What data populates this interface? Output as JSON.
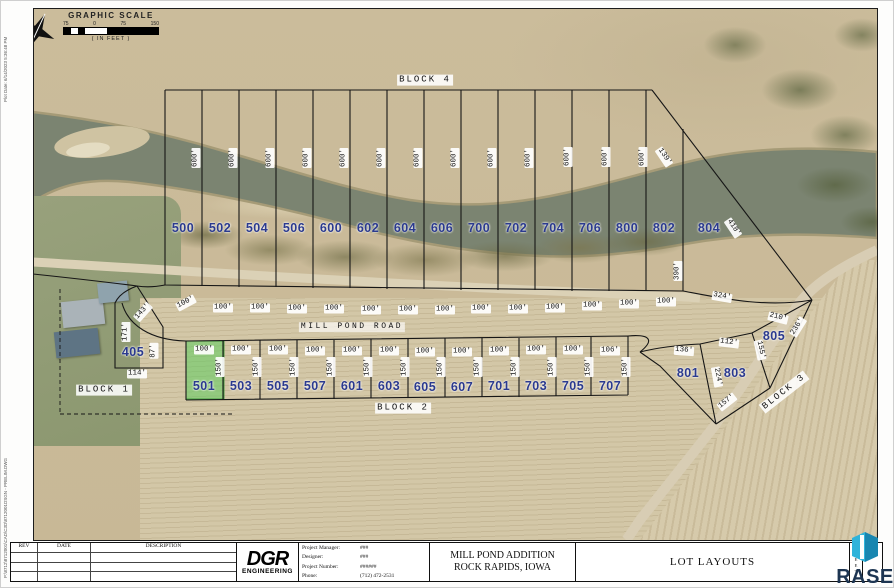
{
  "margins": {
    "plot_date": "Plot Date: 6/14/2023 5:36:48 PM",
    "file_path": "P:\\8712\\8712001\\CAD\\C3D\\8712001DSGN - PRELIM.DWG"
  },
  "scale": {
    "title": "GRAPHIC SCALE",
    "ticks": [
      "75",
      "0",
      "75",
      "150"
    ],
    "units_note": "( IN FEET )"
  },
  "map": {
    "road_label": {
      "text": "MILL POND ROAD"
    },
    "highlighted_lot": "501",
    "colors": {
      "lot_number_text": "#2b3a8f",
      "highlight_green": "#5ecc5e",
      "river": "#7b8471",
      "field": "#d3c7a7"
    },
    "block_labels": [
      {
        "text": "BLOCK 4",
        "x": 425,
        "y": 80,
        "r": 0
      },
      {
        "text": "BLOCK 1",
        "x": 104,
        "y": 390,
        "r": 0
      },
      {
        "text": "BLOCK 2",
        "x": 403,
        "y": 408,
        "r": 0
      },
      {
        "text": "BLOCK 3",
        "x": 784,
        "y": 392,
        "r": -38
      }
    ],
    "lot_numbers": [
      {
        "n": "500",
        "x": 183,
        "y": 228
      },
      {
        "n": "502",
        "x": 220,
        "y": 228
      },
      {
        "n": "504",
        "x": 257,
        "y": 228
      },
      {
        "n": "506",
        "x": 294,
        "y": 228
      },
      {
        "n": "600",
        "x": 331,
        "y": 228
      },
      {
        "n": "602",
        "x": 368,
        "y": 228
      },
      {
        "n": "604",
        "x": 405,
        "y": 228
      },
      {
        "n": "606",
        "x": 442,
        "y": 228
      },
      {
        "n": "700",
        "x": 479,
        "y": 228
      },
      {
        "n": "702",
        "x": 516,
        "y": 228
      },
      {
        "n": "704",
        "x": 553,
        "y": 228
      },
      {
        "n": "706",
        "x": 590,
        "y": 228
      },
      {
        "n": "800",
        "x": 627,
        "y": 228
      },
      {
        "n": "802",
        "x": 664,
        "y": 228
      },
      {
        "n": "804",
        "x": 709,
        "y": 228
      },
      {
        "n": "405",
        "x": 133,
        "y": 352
      },
      {
        "n": "501",
        "x": 204,
        "y": 386,
        "hl": true
      },
      {
        "n": "503",
        "x": 241,
        "y": 386
      },
      {
        "n": "505",
        "x": 278,
        "y": 386
      },
      {
        "n": "507",
        "x": 315,
        "y": 386
      },
      {
        "n": "601",
        "x": 352,
        "y": 386
      },
      {
        "n": "603",
        "x": 389,
        "y": 386
      },
      {
        "n": "605",
        "x": 425,
        "y": 387
      },
      {
        "n": "607",
        "x": 462,
        "y": 387
      },
      {
        "n": "701",
        "x": 499,
        "y": 386
      },
      {
        "n": "703",
        "x": 536,
        "y": 386
      },
      {
        "n": "705",
        "x": 573,
        "y": 386
      },
      {
        "n": "707",
        "x": 610,
        "y": 386
      },
      {
        "n": "801",
        "x": 688,
        "y": 373
      },
      {
        "n": "803",
        "x": 735,
        "y": 373
      },
      {
        "n": "805",
        "x": 774,
        "y": 336
      }
    ],
    "dimensions": [
      {
        "text": "600'",
        "x": 196,
        "y": 158,
        "r": -90
      },
      {
        "text": "600'",
        "x": 233,
        "y": 158,
        "r": -90
      },
      {
        "text": "600'",
        "x": 270,
        "y": 158,
        "r": -90
      },
      {
        "text": "600'",
        "x": 307,
        "y": 158,
        "r": -90
      },
      {
        "text": "600'",
        "x": 344,
        "y": 158,
        "r": -90
      },
      {
        "text": "600'",
        "x": 381,
        "y": 158,
        "r": -90
      },
      {
        "text": "600'",
        "x": 418,
        "y": 158,
        "r": -90
      },
      {
        "text": "600'",
        "x": 455,
        "y": 158,
        "r": -90
      },
      {
        "text": "600'",
        "x": 492,
        "y": 158,
        "r": -90
      },
      {
        "text": "600'",
        "x": 529,
        "y": 158,
        "r": -90
      },
      {
        "text": "600'",
        "x": 568,
        "y": 157,
        "r": -90
      },
      {
        "text": "600'",
        "x": 606,
        "y": 157,
        "r": -90
      },
      {
        "text": "600'",
        "x": 643,
        "y": 157,
        "r": -90
      },
      {
        "text": "139'",
        "x": 664,
        "y": 157,
        "r": 56
      },
      {
        "text": "418'",
        "x": 733,
        "y": 228,
        "r": 56
      },
      {
        "text": "390'",
        "x": 678,
        "y": 271,
        "r": -90
      },
      {
        "text": "324'",
        "x": 722,
        "y": 297,
        "r": 10
      },
      {
        "text": "100'",
        "x": 186,
        "y": 303,
        "r": -28
      },
      {
        "text": "100'",
        "x": 223,
        "y": 308,
        "r": 0
      },
      {
        "text": "100'",
        "x": 260,
        "y": 308,
        "r": 0
      },
      {
        "text": "100'",
        "x": 297,
        "y": 309,
        "r": 0
      },
      {
        "text": "100'",
        "x": 334,
        "y": 309,
        "r": 0
      },
      {
        "text": "100'",
        "x": 371,
        "y": 310,
        "r": 0
      },
      {
        "text": "100'",
        "x": 408,
        "y": 310,
        "r": 0
      },
      {
        "text": "100'",
        "x": 445,
        "y": 310,
        "r": 0
      },
      {
        "text": "100'",
        "x": 481,
        "y": 309,
        "r": 0
      },
      {
        "text": "100'",
        "x": 518,
        "y": 309,
        "r": 0
      },
      {
        "text": "100'",
        "x": 555,
        "y": 308,
        "r": 0
      },
      {
        "text": "100'",
        "x": 592,
        "y": 306,
        "r": 0
      },
      {
        "text": "100'",
        "x": 629,
        "y": 304,
        "r": 0
      },
      {
        "text": "100'",
        "x": 666,
        "y": 302,
        "r": 0
      },
      {
        "text": "100'",
        "x": 204,
        "y": 350,
        "r": 0
      },
      {
        "text": "100'",
        "x": 241,
        "y": 350,
        "r": 0
      },
      {
        "text": "100'",
        "x": 278,
        "y": 350,
        "r": 0
      },
      {
        "text": "100'",
        "x": 315,
        "y": 351,
        "r": 0
      },
      {
        "text": "100'",
        "x": 352,
        "y": 351,
        "r": 0
      },
      {
        "text": "100'",
        "x": 389,
        "y": 351,
        "r": 0
      },
      {
        "text": "100'",
        "x": 425,
        "y": 352,
        "r": 0
      },
      {
        "text": "100'",
        "x": 462,
        "y": 352,
        "r": 0
      },
      {
        "text": "100'",
        "x": 499,
        "y": 351,
        "r": 0
      },
      {
        "text": "100'",
        "x": 536,
        "y": 350,
        "r": 0
      },
      {
        "text": "100'",
        "x": 573,
        "y": 350,
        "r": 0
      },
      {
        "text": "106'",
        "x": 610,
        "y": 351,
        "r": 0
      },
      {
        "text": "150'",
        "x": 220,
        "y": 367,
        "r": -90
      },
      {
        "text": "150'",
        "x": 257,
        "y": 367,
        "r": -90
      },
      {
        "text": "150'",
        "x": 294,
        "y": 367,
        "r": -90
      },
      {
        "text": "150'",
        "x": 331,
        "y": 367,
        "r": -90
      },
      {
        "text": "150'",
        "x": 368,
        "y": 367,
        "r": -90
      },
      {
        "text": "150'",
        "x": 405,
        "y": 367,
        "r": -90
      },
      {
        "text": "150'",
        "x": 441,
        "y": 367,
        "r": -90
      },
      {
        "text": "150'",
        "x": 478,
        "y": 367,
        "r": -90
      },
      {
        "text": "150'",
        "x": 515,
        "y": 367,
        "r": -90
      },
      {
        "text": "150'",
        "x": 552,
        "y": 367,
        "r": -90
      },
      {
        "text": "150'",
        "x": 589,
        "y": 367,
        "r": -90
      },
      {
        "text": "150'",
        "x": 626,
        "y": 367,
        "r": -90
      },
      {
        "text": "143'",
        "x": 143,
        "y": 312,
        "r": -48
      },
      {
        "text": "171'",
        "x": 126,
        "y": 332,
        "r": -90
      },
      {
        "text": "87'",
        "x": 154,
        "y": 351,
        "r": -90
      },
      {
        "text": "114'",
        "x": 137,
        "y": 374,
        "r": 0
      },
      {
        "text": "210'",
        "x": 778,
        "y": 318,
        "r": 14
      },
      {
        "text": "236'",
        "x": 798,
        "y": 327,
        "r": -58
      },
      {
        "text": "112'",
        "x": 729,
        "y": 343,
        "r": 7
      },
      {
        "text": "155'",
        "x": 760,
        "y": 350,
        "r": 78
      },
      {
        "text": "136'",
        "x": 684,
        "y": 351,
        "r": 4
      },
      {
        "text": "224'",
        "x": 717,
        "y": 377,
        "r": 80
      },
      {
        "text": "157'",
        "x": 727,
        "y": 402,
        "r": -38
      }
    ]
  },
  "titleblock": {
    "revisions": {
      "headers": [
        "REV",
        "DATE",
        "DESCRIPTION"
      ],
      "rows": 3
    },
    "company": {
      "name": "DGR",
      "tagline": "ENGINEERING"
    },
    "fields": [
      {
        "label": "Project Manager:",
        "value": "###"
      },
      {
        "label": "Designer:",
        "value": "###"
      },
      {
        "label": "Project Number:",
        "value": "######"
      },
      {
        "label": "Phone:",
        "value": "(712) 472-2531"
      }
    ],
    "project_name_line1": "MILL POND ADDITION",
    "project_name_line2": "ROCK RAPIDS, IOWA",
    "sheet_title": "LOT LAYOUTS",
    "sheet_vertical_label": "SHEET"
  },
  "watermark": {
    "name": "RASE"
  }
}
